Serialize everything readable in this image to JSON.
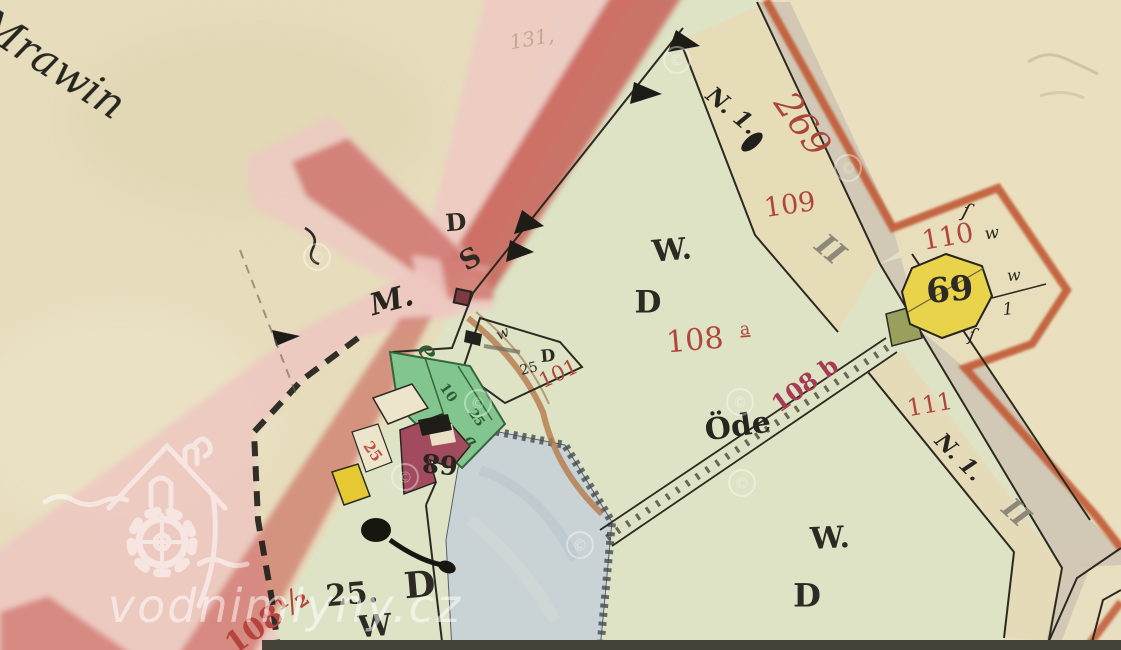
{
  "map": {
    "type": "historical-cadastral-map",
    "palette": {
      "paper": "#e7ddbd",
      "field_green": "#dee3c6",
      "road_pink": "#eec9c3",
      "road_red": "#c4564d",
      "border_orange": "#c05a35",
      "road_strip_gray": "#cfc5b4",
      "pond_blue": "#c9d3d6",
      "garden_green": "#83c58f",
      "building_red": "#a34b5e",
      "building_yellow": "#e5c832",
      "house_octagon_yellow": "#e8d34a",
      "olive_plot": "#99a05e",
      "label_red": "#b0463c",
      "label_crimson": "#a63b55",
      "label_green": "#2f5c36",
      "roman_gray": "#8d897a",
      "ink_black": "#2c2a22"
    },
    "labels": [
      {
        "name": "place-mrawin",
        "text": "m Mrawin",
        "x": 28,
        "y": 52,
        "rot": 33,
        "size": 42,
        "fill": "#26261f",
        "cls": "it",
        "anchor": "start"
      },
      {
        "name": "pencil-131",
        "text": "131,",
        "x": 532,
        "y": 40,
        "rot": -10,
        "size": 20,
        "fill": "#a79d80",
        "cls": "it",
        "opacity": 0.7
      },
      {
        "name": "road-letter-d",
        "text": "D",
        "x": 456,
        "y": 224,
        "rot": -5,
        "size": 24,
        "fill": "#2c2a22",
        "cls": "b"
      },
      {
        "name": "road-letter-s",
        "text": "S",
        "x": 471,
        "y": 260,
        "rot": -30,
        "size": 27,
        "fill": "#2c2a22",
        "cls": "b"
      },
      {
        "name": "road-letter-m",
        "text": "M.",
        "x": 392,
        "y": 302,
        "rot": -15,
        "size": 30,
        "fill": "#26261f",
        "cls": "it b"
      },
      {
        "name": "small-w",
        "text": "w",
        "x": 503,
        "y": 334,
        "rot": -25,
        "size": 15,
        "fill": "#2c2a22",
        "cls": "it"
      },
      {
        "name": "small-25",
        "text": "25",
        "x": 529,
        "y": 369,
        "rot": -15,
        "size": 14,
        "fill": "#2c2a22",
        "cls": ""
      },
      {
        "name": "small-d",
        "text": "D",
        "x": 548,
        "y": 357,
        "rot": -5,
        "size": 17,
        "fill": "#2c2a22",
        "cls": "b"
      },
      {
        "name": "parcel-101",
        "text": "101",
        "x": 559,
        "y": 375,
        "rot": -25,
        "size": 21,
        "fill": "#b0463c",
        "cls": ""
      },
      {
        "name": "field-letter-w",
        "text": "W.",
        "x": 672,
        "y": 252,
        "rot": -5,
        "size": 30,
        "fill": "#2c2a22",
        "cls": "b"
      },
      {
        "name": "field-letter-d",
        "text": "D",
        "x": 648,
        "y": 304,
        "rot": 0,
        "size": 31,
        "fill": "#2c2a22",
        "cls": "b"
      },
      {
        "name": "parcel-108",
        "text": "108",
        "x": 695,
        "y": 342,
        "rot": -5,
        "size": 30,
        "fill": "#b0463c",
        "cls": ""
      },
      {
        "name": "parcel-108-sub-a",
        "text": "a",
        "x": 745,
        "y": 330,
        "rot": -5,
        "size": 17,
        "fill": "#b0463c",
        "cls": "u"
      },
      {
        "name": "parcel-109",
        "text": "109",
        "x": 790,
        "y": 206,
        "rot": -8,
        "size": 27,
        "fill": "#b0463c",
        "cls": ""
      },
      {
        "name": "parcel-269",
        "text": "269",
        "x": 800,
        "y": 126,
        "rot": 55,
        "size": 36,
        "fill": "#a8463a",
        "cls": "it"
      },
      {
        "name": "cursive-n1-top",
        "text": "N. 1.",
        "x": 731,
        "y": 112,
        "rot": 40,
        "size": 23,
        "fill": "#26261f",
        "cls": "it b"
      },
      {
        "name": "roman-ii-top",
        "text": "II",
        "x": 829,
        "y": 251,
        "rot": 40,
        "size": 30,
        "fill": "#8d897a",
        "cls": "it b"
      },
      {
        "name": "parcel-110",
        "text": "110",
        "x": 948,
        "y": 238,
        "rot": -10,
        "size": 27,
        "fill": "#b0463c",
        "cls": ""
      },
      {
        "name": "cursive-w-110",
        "text": "w",
        "x": 992,
        "y": 234,
        "rot": -8,
        "size": 17,
        "fill": "#26261f",
        "cls": "it"
      },
      {
        "name": "house-69",
        "text": "69",
        "x": 950,
        "y": 292,
        "rot": -5,
        "size": 34,
        "fill": "#2c2a22",
        "cls": "b"
      },
      {
        "name": "cursive-squiggle-top",
        "text": "ſ",
        "x": 966,
        "y": 212,
        "rot": 15,
        "size": 20,
        "fill": "#26261f",
        "cls": "it"
      },
      {
        "name": "cursive-w-east",
        "text": "w",
        "x": 1014,
        "y": 276,
        "rot": -5,
        "size": 16,
        "fill": "#26261f",
        "cls": "it"
      },
      {
        "name": "cursive-one",
        "text": "1",
        "x": 1008,
        "y": 310,
        "rot": -5,
        "size": 17,
        "fill": "#26261f",
        "cls": "it"
      },
      {
        "name": "cursive-squiggle-bottom",
        "text": "ſ",
        "x": 972,
        "y": 336,
        "rot": 10,
        "size": 18,
        "fill": "#26261f",
        "cls": "it"
      },
      {
        "name": "parcel-111",
        "text": "111",
        "x": 930,
        "y": 406,
        "rot": -10,
        "size": 24,
        "fill": "#b0463c",
        "cls": ""
      },
      {
        "name": "cursive-n1-bottom",
        "text": "N. 1.",
        "x": 958,
        "y": 458,
        "rot": 45,
        "size": 22,
        "fill": "#26261f",
        "cls": "it b"
      },
      {
        "name": "roman-ii-bottom",
        "text": "II",
        "x": 1015,
        "y": 514,
        "rot": 42,
        "size": 28,
        "fill": "#8d897a",
        "cls": "it b"
      },
      {
        "name": "meadow-ode",
        "text": "Öde",
        "x": 738,
        "y": 428,
        "rot": -8,
        "size": 30,
        "fill": "#26261f",
        "cls": "b"
      },
      {
        "name": "track-108b",
        "text": "108 b",
        "x": 806,
        "y": 386,
        "rot": -36,
        "size": 24,
        "fill": "#a63b55",
        "cls": "b"
      },
      {
        "name": "garden-e",
        "text": "e",
        "x": 427,
        "y": 352,
        "rot": 55,
        "size": 26,
        "fill": "#2f5c36",
        "cls": "it b"
      },
      {
        "name": "garden-10",
        "text": "10",
        "x": 448,
        "y": 393,
        "rot": 55,
        "size": 14,
        "fill": "#2f5c36",
        "cls": "b"
      },
      {
        "name": "garden-25",
        "text": "25",
        "x": 476,
        "y": 418,
        "rot": 55,
        "size": 13,
        "fill": "#2f5c36",
        "cls": "b"
      },
      {
        "name": "garden-a",
        "text": "a",
        "x": 471,
        "y": 441,
        "rot": 55,
        "size": 16,
        "fill": "#2f5c36",
        "cls": "it b"
      },
      {
        "name": "house-25-red",
        "text": "25",
        "x": 372,
        "y": 452,
        "rot": 55,
        "size": 15,
        "fill": "#c24f46",
        "cls": "b"
      },
      {
        "name": "house-68",
        "text": "68",
        "x": 440,
        "y": 462,
        "rot": 185,
        "size": 26,
        "fill": "#26261f",
        "cls": "b"
      },
      {
        "name": "parcel-25d-25",
        "text": "25.",
        "x": 352,
        "y": 596,
        "rot": -5,
        "size": 30,
        "fill": "#2c2a22",
        "cls": "b"
      },
      {
        "name": "parcel-25d-d",
        "text": "D",
        "x": 420,
        "y": 588,
        "rot": -5,
        "size": 36,
        "fill": "#2c2a22",
        "cls": "b"
      },
      {
        "name": "parcel-25d-w",
        "text": "W",
        "x": 375,
        "y": 628,
        "rot": -5,
        "size": 30,
        "fill": "#2c2a22",
        "cls": "b"
      },
      {
        "name": "parcel-108half",
        "text": "108½",
        "x": 268,
        "y": 622,
        "rot": -35,
        "size": 30,
        "fill": "#b5443c",
        "cls": "b"
      },
      {
        "name": "bottom-right-w",
        "text": "W.",
        "x": 830,
        "y": 540,
        "rot": -3,
        "size": 30,
        "fill": "#2c2a22",
        "cls": "b"
      },
      {
        "name": "bottom-right-d",
        "text": "D",
        "x": 807,
        "y": 598,
        "rot": 0,
        "size": 32,
        "fill": "#2c2a22",
        "cls": "b"
      }
    ]
  },
  "watermark": {
    "site_label": "vodnimlyny.cz",
    "copyright_symbol": "©",
    "copyright_positions": [
      [
        317,
        257
      ],
      [
        677,
        60
      ],
      [
        848,
        168
      ],
      [
        740,
        402
      ],
      [
        478,
        403
      ],
      [
        405,
        477
      ],
      [
        580,
        545
      ],
      [
        742,
        483
      ]
    ]
  }
}
